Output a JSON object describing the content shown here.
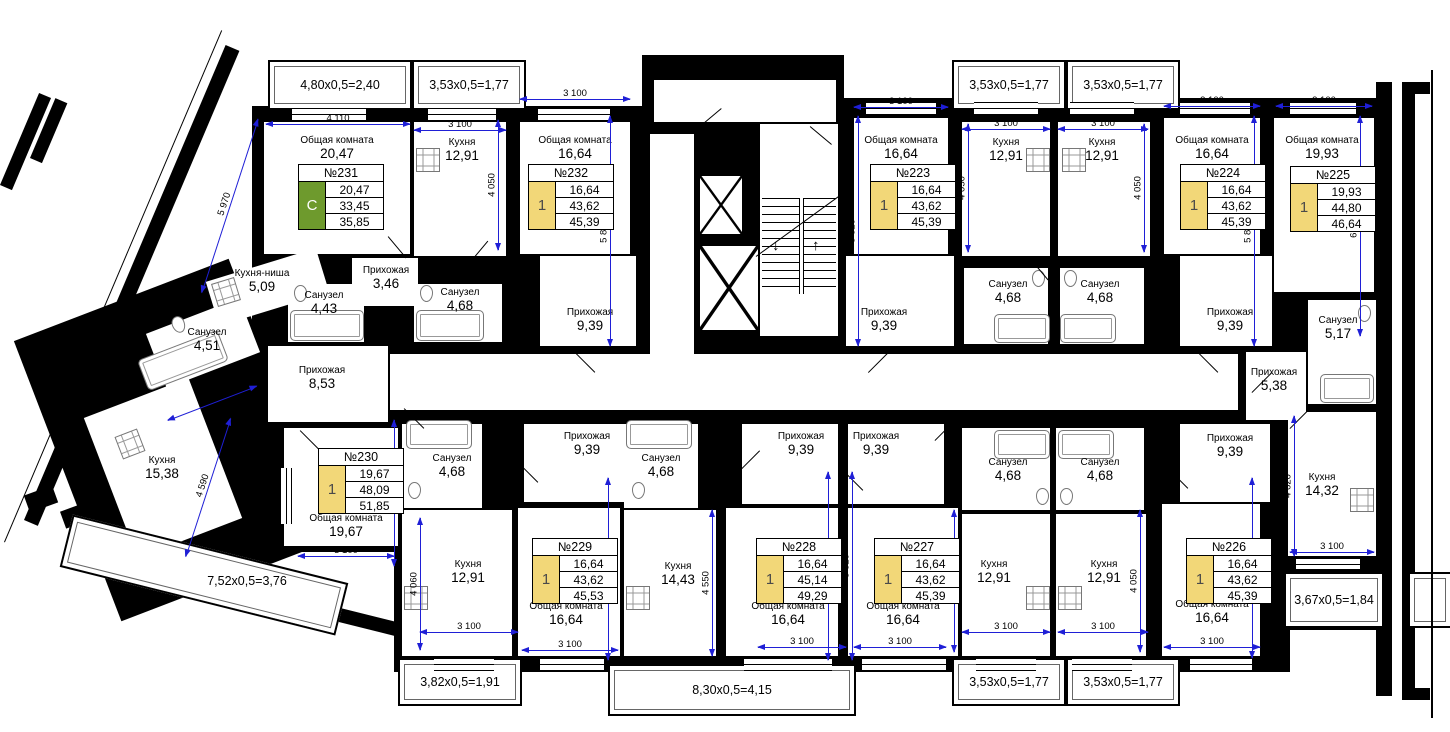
{
  "colors": {
    "wall": "#000000",
    "dimension_line": "#1f1fd6",
    "studio_badge": "#6e9a2d",
    "one_room_badge": "#f2d778"
  },
  "apartments": [
    {
      "number": "№231",
      "type": "C",
      "rows": [
        "20,47",
        "33,45",
        "35,85"
      ]
    },
    {
      "number": "№232",
      "type": "1",
      "rows": [
        "16,64",
        "43,62",
        "45,39"
      ]
    },
    {
      "number": "№223",
      "type": "1",
      "rows": [
        "16,64",
        "43,62",
        "45,39"
      ]
    },
    {
      "number": "№224",
      "type": "1",
      "rows": [
        "16,64",
        "43,62",
        "45,39"
      ]
    },
    {
      "number": "№225",
      "type": "1",
      "rows": [
        "19,93",
        "44,80",
        "46,64"
      ]
    },
    {
      "number": "№226",
      "type": "1",
      "rows": [
        "16,64",
        "43,62",
        "45,39"
      ]
    },
    {
      "number": "№227",
      "type": "1",
      "rows": [
        "16,64",
        "43,62",
        "45,39"
      ]
    },
    {
      "number": "№228",
      "type": "1",
      "rows": [
        "16,64",
        "45,14",
        "49,29"
      ]
    },
    {
      "number": "№229",
      "type": "1",
      "rows": [
        "16,64",
        "43,62",
        "45,53"
      ]
    },
    {
      "number": "№230",
      "type": "1",
      "rows": [
        "19,67",
        "48,09",
        "51,85"
      ]
    }
  ],
  "rooms": [
    {
      "name": "Общая комната",
      "area": "20,47"
    },
    {
      "name": "Кухня",
      "area": "12,91"
    },
    {
      "name": "Общая комната",
      "area": "16,64"
    },
    {
      "name": "Кухня-ниша",
      "area": "5,09"
    },
    {
      "name": "Санузел",
      "area": "4,43"
    },
    {
      "name": "Прихожая",
      "area": "3,46"
    },
    {
      "name": "Санузел",
      "area": "4,68"
    },
    {
      "name": "Прихожая",
      "area": "9,39"
    },
    {
      "name": "Общая комната",
      "area": "16,64"
    },
    {
      "name": "Кухня",
      "area": "12,91"
    },
    {
      "name": "Санузел",
      "area": "4,68"
    },
    {
      "name": "Прихожая",
      "area": "9,39"
    },
    {
      "name": "Кухня",
      "area": "12,91"
    },
    {
      "name": "Санузел",
      "area": "4,68"
    },
    {
      "name": "Общая комната",
      "area": "16,64"
    },
    {
      "name": "Прихожая",
      "area": "9,39"
    },
    {
      "name": "Общая комната",
      "area": "19,93"
    },
    {
      "name": "Санузел",
      "area": "5,17"
    },
    {
      "name": "Прихожая",
      "area": "5,38"
    },
    {
      "name": "Кухня",
      "area": "14,32"
    },
    {
      "name": "Санузел",
      "area": "4,51"
    },
    {
      "name": "Прихожая",
      "area": "8,53"
    },
    {
      "name": "Кухня",
      "area": "15,38"
    },
    {
      "name": "Общая комната",
      "area": "19,67"
    },
    {
      "name": "Санузел",
      "area": "4,68"
    },
    {
      "name": "Прихожая",
      "area": "9,39"
    },
    {
      "name": "Кухня",
      "area": "12,91"
    },
    {
      "name": "Общая комната",
      "area": "16,64"
    },
    {
      "name": "Санузел",
      "area": "4,68"
    },
    {
      "name": "Кухня",
      "area": "14,43"
    },
    {
      "name": "Прихожая",
      "area": "9,39"
    },
    {
      "name": "Общая комната",
      "area": "16,64"
    },
    {
      "name": "Прихожая",
      "area": "9,39"
    },
    {
      "name": "Общая комната",
      "area": "16,64"
    },
    {
      "name": "Санузел",
      "area": "4,68"
    },
    {
      "name": "Кухня",
      "area": "12,91"
    },
    {
      "name": "Санузел",
      "area": "4,68"
    },
    {
      "name": "Кухня",
      "area": "12,91"
    },
    {
      "name": "Прихожая",
      "area": "9,39"
    },
    {
      "name": "Общая комната",
      "area": "16,64"
    }
  ],
  "dims": [
    {
      "label": "4 110"
    },
    {
      "label": "3 100"
    },
    {
      "label": "3 100"
    },
    {
      "label": "3 100"
    },
    {
      "label": "3 100"
    },
    {
      "label": "3 100"
    },
    {
      "label": "3 100"
    },
    {
      "label": "3 100"
    },
    {
      "label": "3 100"
    },
    {
      "label": "3 100"
    },
    {
      "label": "3 100"
    },
    {
      "label": "3 100"
    },
    {
      "label": "3 100"
    },
    {
      "label": "3 100"
    },
    {
      "label": "3 100"
    },
    {
      "label": "3 100"
    },
    {
      "label": "3 100"
    },
    {
      "label": "4 050"
    },
    {
      "label": "5 820"
    },
    {
      "label": "5 820"
    },
    {
      "label": "4 050"
    },
    {
      "label": "4 050"
    },
    {
      "label": "5 820"
    },
    {
      "label": "6 450"
    },
    {
      "label": "4 620"
    },
    {
      "label": "5 820"
    },
    {
      "label": "4 050"
    },
    {
      "label": "4 050"
    },
    {
      "label": "5 820"
    },
    {
      "label": "5 820"
    },
    {
      "label": "4 550"
    },
    {
      "label": "5 820"
    },
    {
      "label": "4 060"
    },
    {
      "label": "4 500"
    },
    {
      "label": "5 970"
    },
    {
      "label": "3 300"
    },
    {
      "label": "4 590"
    }
  ],
  "balconies": [
    {
      "label": "4,80x0,5=2,40"
    },
    {
      "label": "3,53x0,5=1,77"
    },
    {
      "label": "3,53x0,5=1,77"
    },
    {
      "label": "3,53x0,5=1,77"
    },
    {
      "label": "3,53x0,5=1,77"
    },
    {
      "label": "3,53x0,5=1,77"
    },
    {
      "label": "3,82x0,5=1,91"
    },
    {
      "label": "8,30x0,5=4,15"
    },
    {
      "label": "3,67x0,5=1,84"
    },
    {
      "label": "7,52x0,5=3,76"
    }
  ]
}
